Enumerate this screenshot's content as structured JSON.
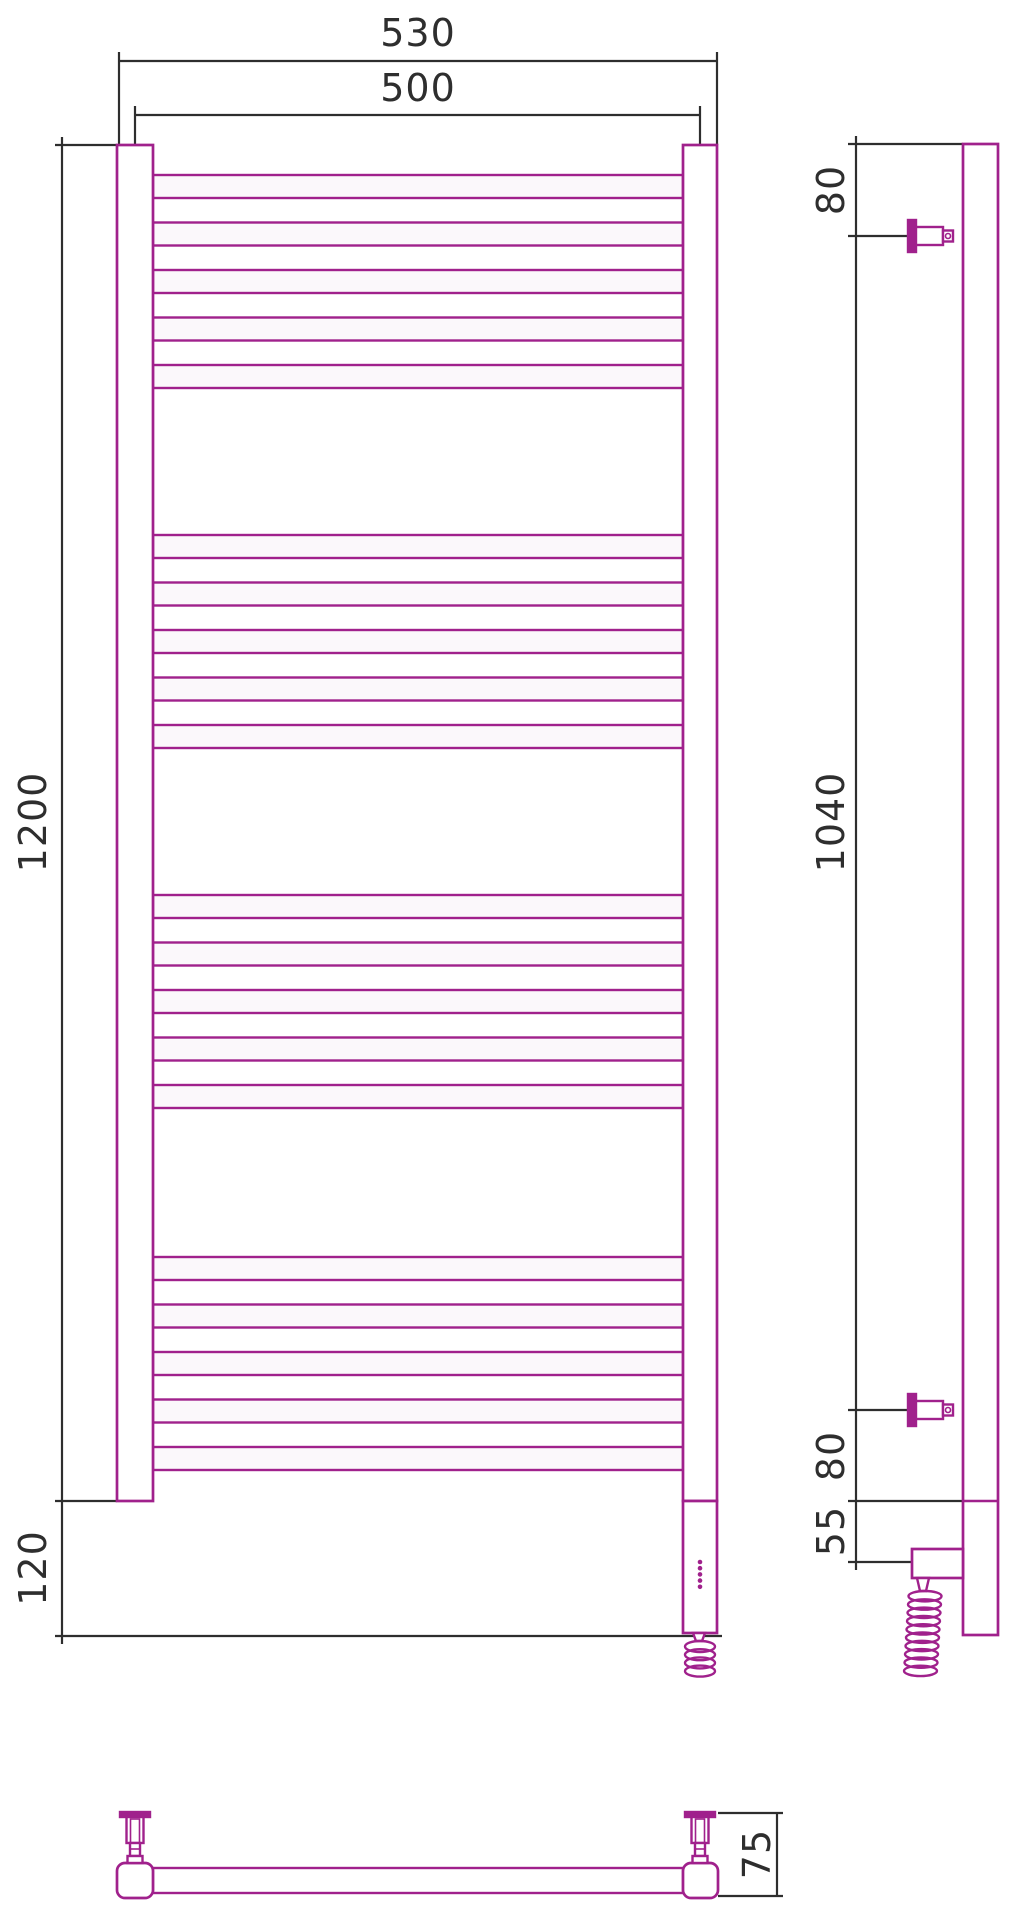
{
  "drawing": {
    "title": "heated towel rail technical drawing",
    "views": [
      "front-view",
      "side-view",
      "bottom-view"
    ]
  },
  "dimensions": {
    "overall_width": "530",
    "rail_width": "500",
    "overall_height": "1200",
    "heater_section_height": "120",
    "top_bracket_offset": "80",
    "bracket_spacing": "1040",
    "bottom_bracket_offset": "80",
    "heater_offset": "55",
    "wall_depth": "75"
  },
  "colors": {
    "product": "#A0218C",
    "dims": "#2e2e2e",
    "bg": "#ffffff",
    "tube_fill": "#fbf8fb",
    "white": "#ffffff"
  },
  "geometry": {
    "canvas": {
      "w": 1019,
      "h": 1920
    },
    "front": {
      "post_left": {
        "x": 117,
        "w": 36
      },
      "post_right": {
        "x": 683,
        "w": 34
      },
      "post_top": 145,
      "post_bottom": 1501,
      "tube_x1": 153,
      "tube_x2": 683,
      "tube_h": 23,
      "group_tops": [
        175,
        535,
        895,
        1257
      ],
      "tube_pitch": 47.5,
      "tubes_per_group": 5,
      "housing": {
        "x": 683,
        "w": 34,
        "y": 1501,
        "h": 132
      },
      "dots": {
        "cx": 700,
        "y0": 1562,
        "dy": 6.2,
        "n": 5,
        "r": 2.3
      },
      "coil": {
        "cx": 700,
        "top": 1641,
        "loops": 4,
        "rx": 15,
        "ry": 5.5,
        "pitch": 8.2,
        "drift": 0
      }
    },
    "side": {
      "bar": {
        "x": 963,
        "w": 35,
        "y1": 144,
        "y2": 1635,
        "seam_y": 1501
      },
      "bracket_centers": [
        236,
        1410
      ],
      "bracket": {
        "flange_x": 908,
        "flange_w": 8,
        "flange_h": 32,
        "barrel_x": 916,
        "barrel_w": 27,
        "barrel_h": 18,
        "small_x": 943,
        "small_w": 10,
        "small_h": 11,
        "circle_x": 948,
        "circle_r": 2.5
      },
      "housing": {
        "x": 912,
        "y": 1549,
        "w": 51,
        "h": 29
      },
      "coil": {
        "cx": 925,
        "top": 1591,
        "loops": 10,
        "rx": 16.5,
        "ry": 5.2,
        "pitch": 8.3,
        "drift": -0.5
      }
    },
    "bottom": {
      "tube": {
        "x1": 153,
        "x2": 683,
        "y": 1868,
        "h": 25
      },
      "sections": [
        {
          "x": 117,
          "w": 36
        },
        {
          "x": 683,
          "w": 35
        }
      ],
      "sec_y": 1863,
      "sec_h": 35,
      "sec_r": 8,
      "bracket_cx": [
        135,
        700
      ],
      "bracket": {
        "flange_w": 30,
        "flange_y": 1812,
        "flange_h": 5,
        "barrel_w": 17,
        "barrel_y": 1817,
        "barrel_h": 26,
        "inner_w": 9,
        "neck_w": 10,
        "neck_y": 1843,
        "neck_h": 13,
        "base_w": 15,
        "base_y": 1856,
        "base_h": 7
      }
    },
    "dims": {
      "h": [
        {
          "key": "overall_width",
          "y": 61,
          "x1": 119,
          "x2": 717,
          "ext_top": 52,
          "ext_to": 145,
          "lx": 418,
          "lby": 46
        },
        {
          "key": "rail_width",
          "y": 115,
          "x1": 135,
          "x2": 700,
          "ext_top": 106,
          "ext_to": 145,
          "lx": 418,
          "lby": 101
        }
      ],
      "v_front": {
        "x": 62,
        "top": 137,
        "bottom": 1644,
        "exts": [
          {
            "y": 145,
            "x1": 55,
            "x2": 117
          },
          {
            "y": 1501,
            "x1": 55,
            "x2": 117
          },
          {
            "y": 1636,
            "x1": 55,
            "x2": 722
          }
        ],
        "labels": [
          {
            "key": "overall_height",
            "lx": 46,
            "ly": 822
          },
          {
            "key": "heater_section_height",
            "lx": 46,
            "ly": 1568
          }
        ]
      },
      "v_side": {
        "x": 856,
        "top": 136,
        "bottom": 1570,
        "exts": [
          {
            "y": 144,
            "x1": 848,
            "x2": 963
          },
          {
            "y": 236,
            "x1": 848,
            "x2": 908
          },
          {
            "y": 1410,
            "x1": 848,
            "x2": 908
          },
          {
            "y": 1501,
            "x1": 848,
            "x2": 998
          },
          {
            "y": 1562,
            "x1": 848,
            "x2": 912
          }
        ],
        "labels": [
          {
            "key": "top_bracket_offset",
            "lx": 844,
            "ly": 190
          },
          {
            "key": "bracket_spacing",
            "lx": 844,
            "ly": 822
          },
          {
            "key": "bottom_bracket_offset",
            "lx": 844,
            "ly": 1456
          },
          {
            "key": "heater_offset",
            "lx": 844,
            "ly": 1531
          }
        ]
      },
      "v_depth": {
        "x": 777,
        "y1": 1813,
        "y2": 1896,
        "exts": [
          {
            "y": 1813,
            "x1": 718,
            "x2": 783
          },
          {
            "y": 1896,
            "x1": 718,
            "x2": 783
          }
        ],
        "label": {
          "key": "wall_depth",
          "lx": 770,
          "ly": 1854
        }
      }
    },
    "stroke": {
      "product": 2.7,
      "tube": 2.4,
      "dim": 2.2,
      "font": 38
    }
  }
}
